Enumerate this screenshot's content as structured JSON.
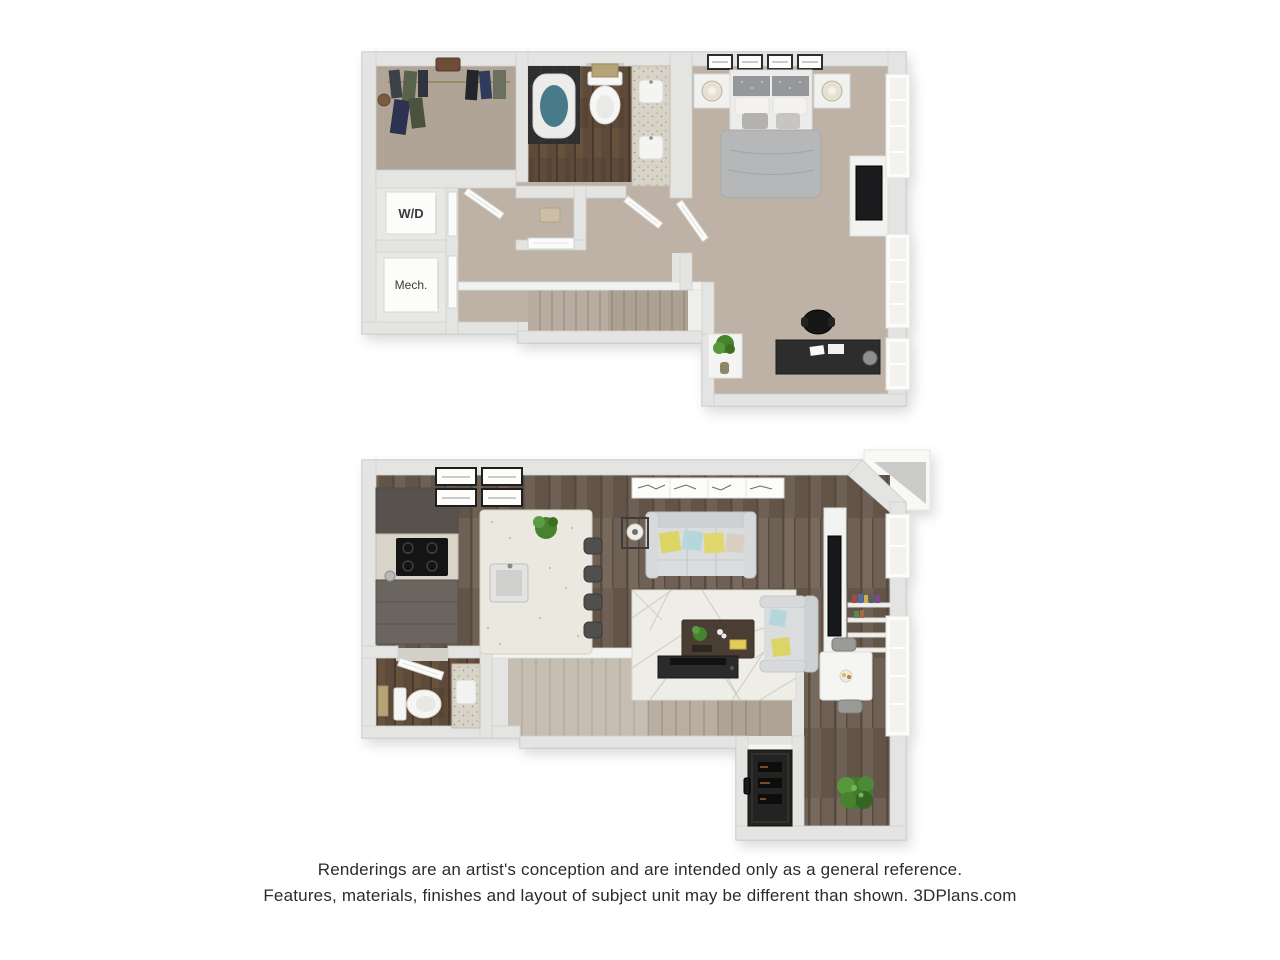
{
  "disclaimer": {
    "line1": "Renderings are an artist's conception and are intended only as a general reference.",
    "line2": "Features, materials, finishes and layout of subject unit may be different than shown. 3DPlans.com"
  },
  "upper_floor": {
    "washer_dryer_label": "W/D",
    "mechanical_label": "Mech."
  },
  "colors": {
    "wall": "#e4e4e3",
    "wall_edge": "#c9c9c7",
    "carpet": "#bdb2a5",
    "closet_carpet": "#b0a496",
    "stair_carpet": "#b7ac9f",
    "wood_floor": "#6e6055",
    "bath_wood_floor": "#5e4a3b",
    "shower_tile": "#2f2e30",
    "tub_water": "#487a89",
    "counter_speckle": "#d8d3c7",
    "kitchen_cabinet": "#6b6560",
    "island": "#ebe8e0",
    "sofa": "#d7d9da",
    "pillow_yellow": "#ddd468",
    "pillow_blue": "#b5d6db",
    "rug": "#eeede7",
    "plant_green": "#47822f",
    "towel_tan": "#b5a477",
    "text": "#2b2b2b"
  }
}
